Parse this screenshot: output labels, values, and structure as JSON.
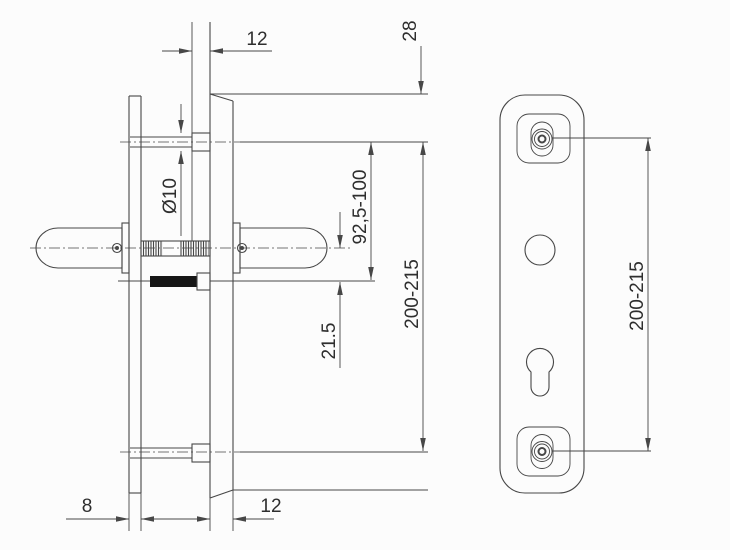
{
  "drawing": {
    "kind": "door-handle-fitting-dimension-drawing",
    "side_view": {
      "dim_spindle_projection_top": "12",
      "dim_plate_top_to_screw": "28",
      "dim_screw_hole_diameter": "Ø10",
      "dim_screw_to_cylinder": "92,5-100",
      "dim_handle_to_cylinder": "21.5",
      "dim_fixing_centres": "200-215",
      "dim_plate_thickness": "8",
      "dim_door_offset_bottom": "12"
    },
    "front_view": {
      "dim_fixing_centres": "200-215"
    },
    "colors": {
      "line": "#474747",
      "text": "#2e2e2e",
      "background": "#fcfcfc",
      "bolt_fill": "#161616"
    }
  }
}
